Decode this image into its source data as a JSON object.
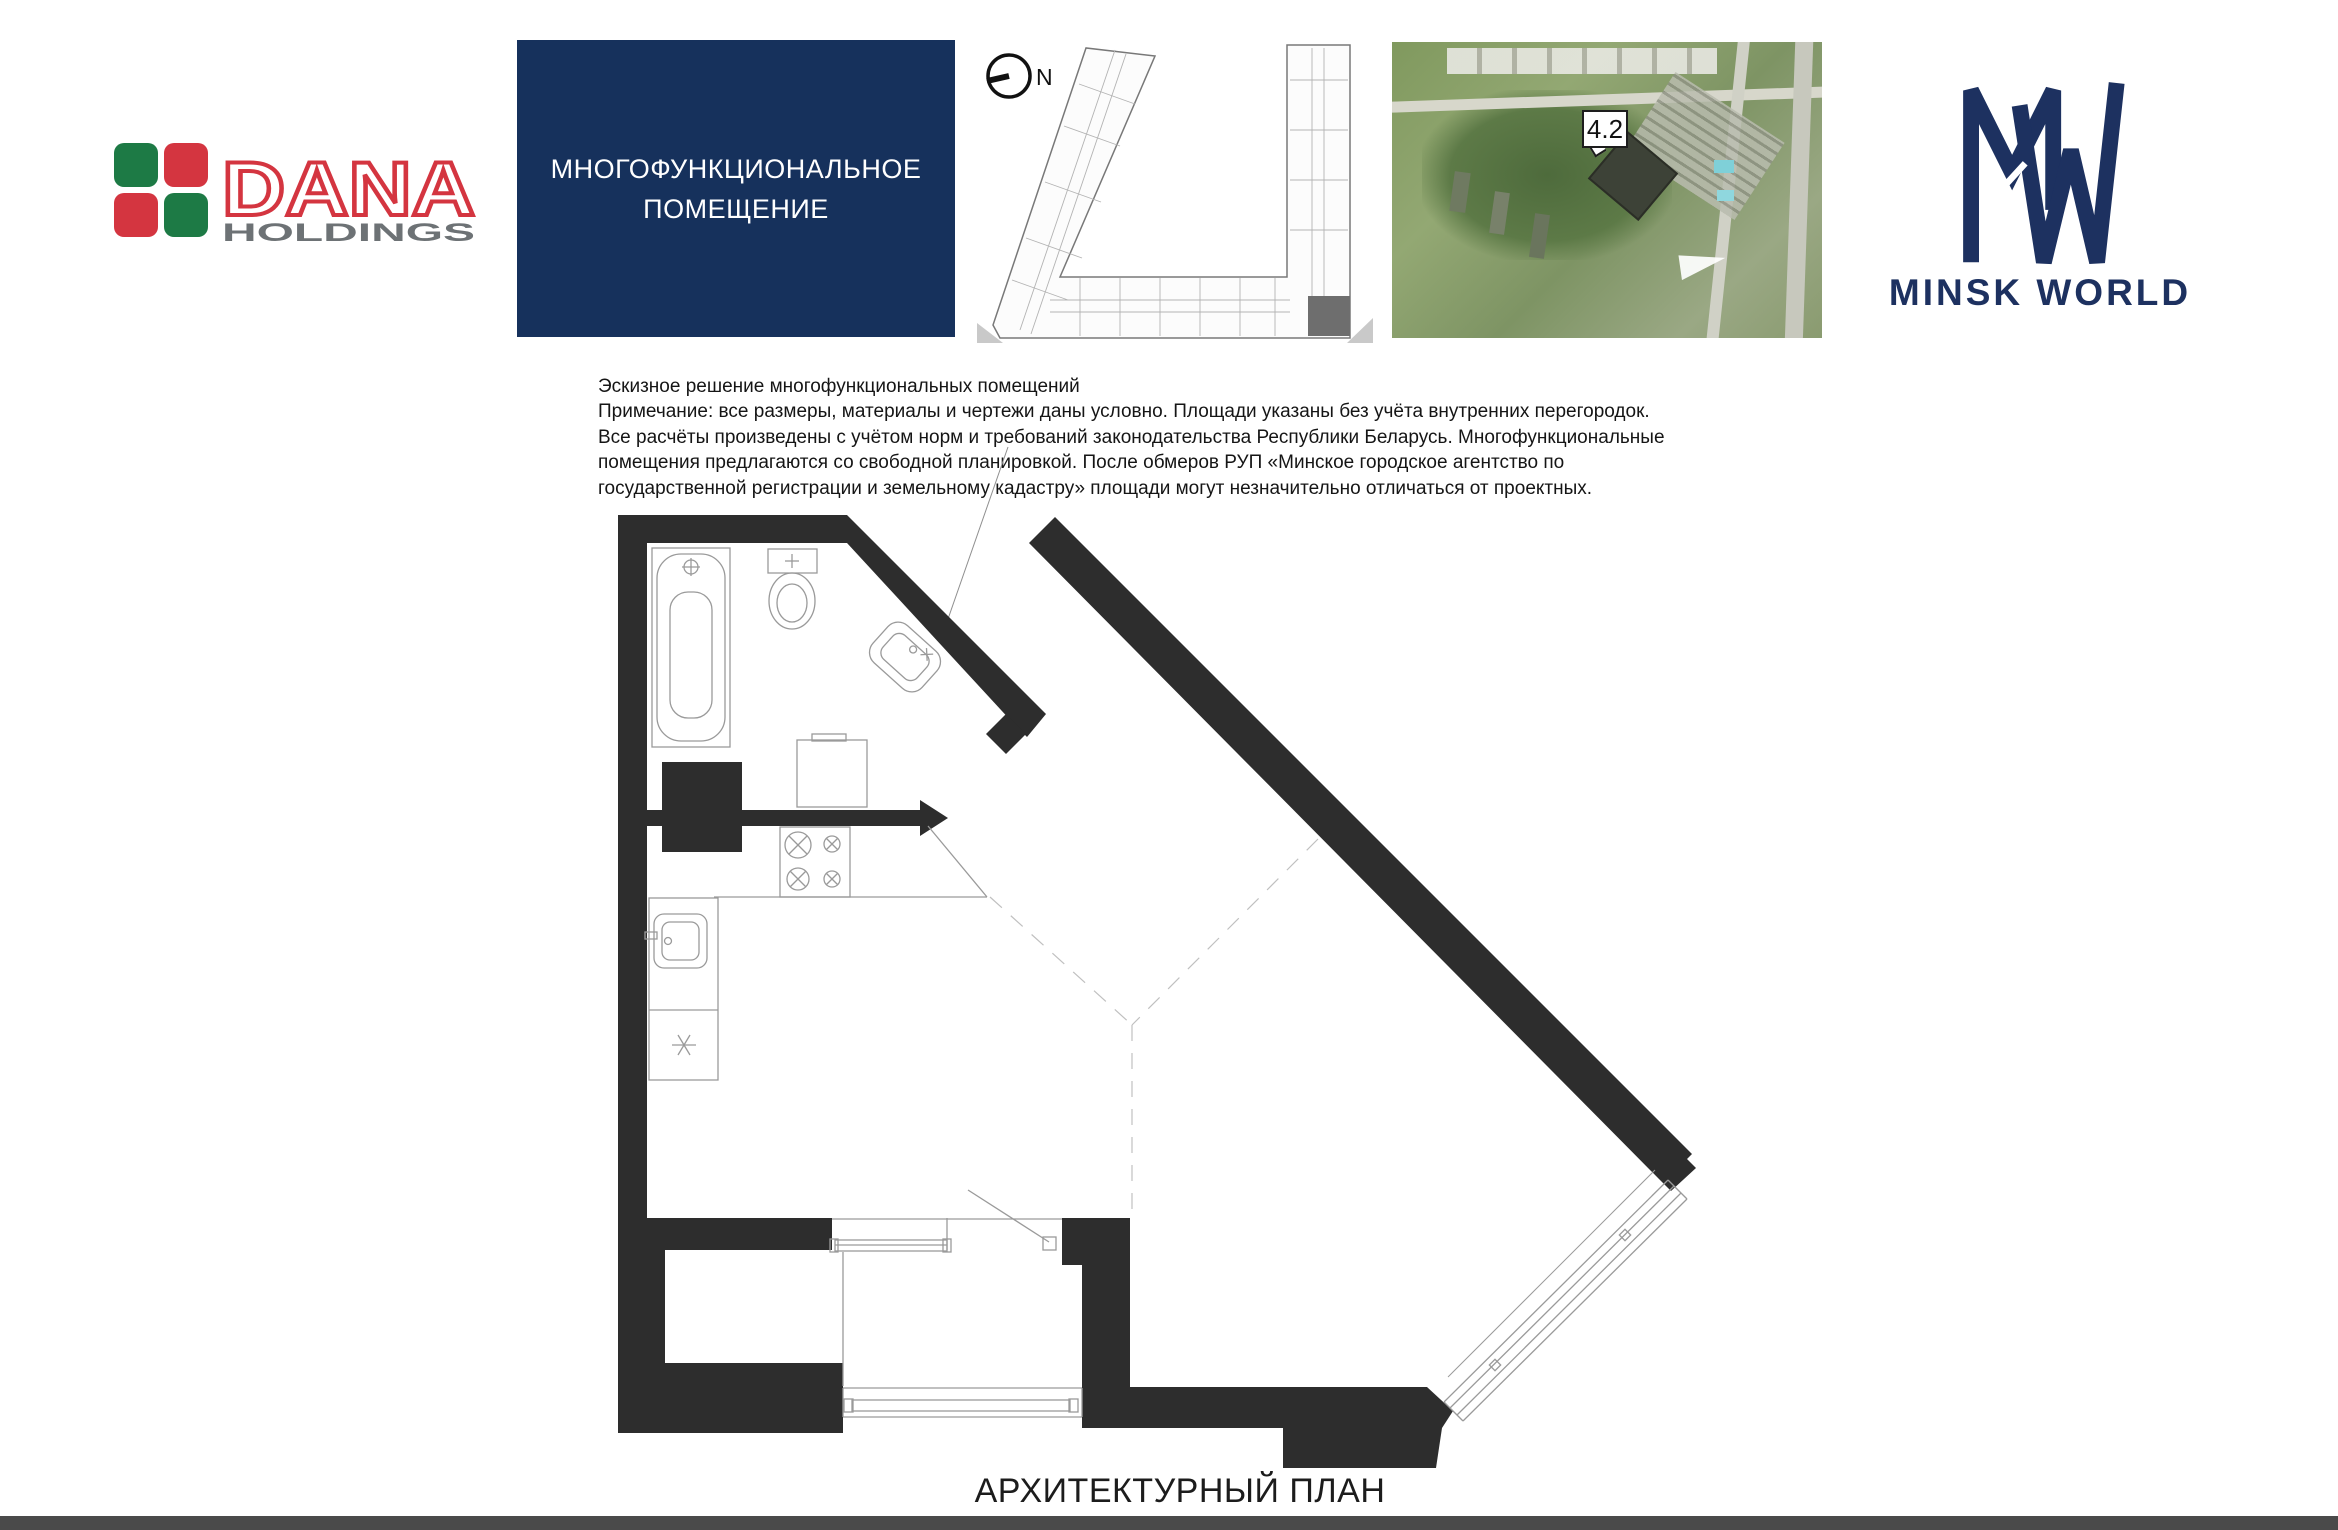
{
  "brand": {
    "dana": {
      "name": "DANA",
      "sub": "HOLDINGS",
      "red": "#d43540",
      "green": "#1d7a45",
      "gray": "#6d7275"
    },
    "minsk_world": {
      "name": "MINSK WORLD",
      "navy": "#1d3160"
    }
  },
  "header": {
    "unit_type_line1": "МНОГОФУНКЦИОНАЛЬНОЕ",
    "unit_type_line2": "ПОМЕЩЕНИЕ",
    "unit_type_box_bg": "#16315c",
    "compass_label": "N",
    "building_callout": "4.2"
  },
  "note": {
    "lines": [
      "Эскизное решение многофункциональных помещений",
      "Примечание: все размеры, материалы и чертежи даны условно. Площади указаны без учёта внутренних перегородок.",
      "Все расчёты произведены с учётом норм и требований законодательства Республики Беларусь. Многофункциональные",
      "помещения предлагаются со свободной планировкой. После обмеров РУП «Минское городское агентство по",
      "государственной регистрации и земельному кадастру» площади могут незначительно отличаться от проектных."
    ]
  },
  "plan": {
    "caption": "АРХИТЕКТУРНЫЙ ПЛАН",
    "wall_color": "#2d2d2d",
    "fixture_line_color": "#9a9a9a",
    "dashed_line_color": "#c0c0c0"
  }
}
